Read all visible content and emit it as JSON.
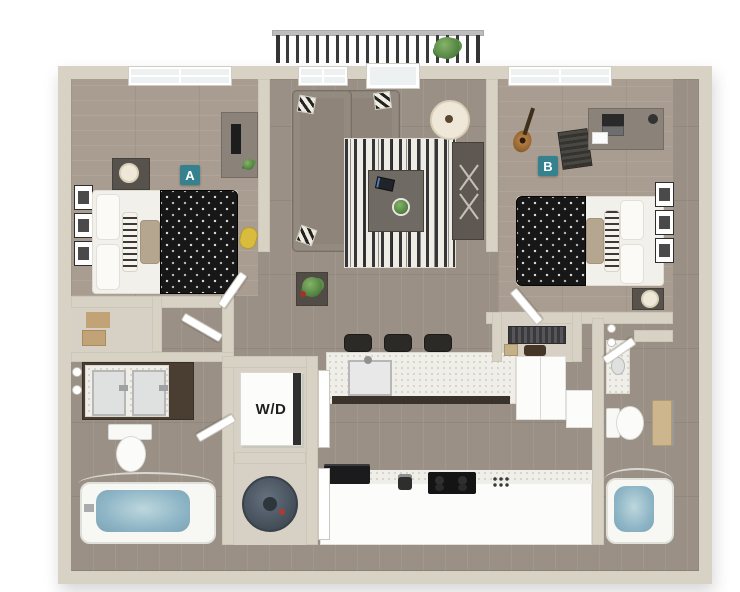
{
  "scene": {
    "kind": "3d-apartment-floor-plan",
    "background": "#ffffff"
  },
  "labels": {
    "bedroom_a": "A",
    "bedroom_b": "B",
    "washer_dryer": "W/D"
  },
  "colors": {
    "label-accent": "#35828e",
    "wall": "#d8d2c5",
    "floor-main": "#9a9085",
    "floor-bedroom": "#a89d90",
    "water": "#8fb6c6",
    "sofa": "#8e8479",
    "duvet": "#171717",
    "cabinet-dark": "#4a3e33",
    "counter": "#f0eee8",
    "railing": "#3a3a3a",
    "plant": "#5d9149"
  },
  "rooms": [
    {
      "id": "bedroom-a",
      "label": "A",
      "furniture": [
        "window",
        "bed",
        "polka-dot-duvet",
        "pillows",
        "nightstand",
        "table-lamp",
        "desk",
        "monitor",
        "wall-art-frames",
        "duffel-bag"
      ]
    },
    {
      "id": "living-room",
      "furniture": [
        "window",
        "balcony-door",
        "sectional-sofa",
        "accent-pillows",
        "striped-area-rug",
        "coffee-table",
        "tablet",
        "potted-plant",
        "floor-lamp",
        "media-console",
        "plant-side-table"
      ]
    },
    {
      "id": "bedroom-b",
      "label": "B",
      "furniture": [
        "window",
        "bed",
        "polka-dot-duvet",
        "pillows",
        "nightstand",
        "table-lamp",
        "desk",
        "laptop",
        "desk-chair",
        "guitar",
        "wall-art-frames"
      ]
    },
    {
      "id": "bathroom-a",
      "furniture": [
        "double-vanity",
        "sinks",
        "toilet",
        "bathtub",
        "shower-rod",
        "linen-shelves",
        "towels"
      ]
    },
    {
      "id": "laundry-closet",
      "label": "W/D",
      "furniture": [
        "stacked-washer-dryer"
      ]
    },
    {
      "id": "utility-closet",
      "furniture": [
        "water-heater"
      ]
    },
    {
      "id": "kitchen",
      "furniture": [
        "island",
        "sink",
        "bar-stools",
        "refrigerator",
        "corner-cabinet",
        "cooktop",
        "microwave",
        "coffee-maker",
        "closet-with-clothes"
      ]
    },
    {
      "id": "bathroom-b",
      "furniture": [
        "vanity",
        "sink",
        "toilet",
        "towel-bar",
        "bathtub",
        "shower-rod"
      ]
    },
    {
      "id": "balcony",
      "furniture": [
        "railing",
        "potted-plant"
      ]
    }
  ]
}
